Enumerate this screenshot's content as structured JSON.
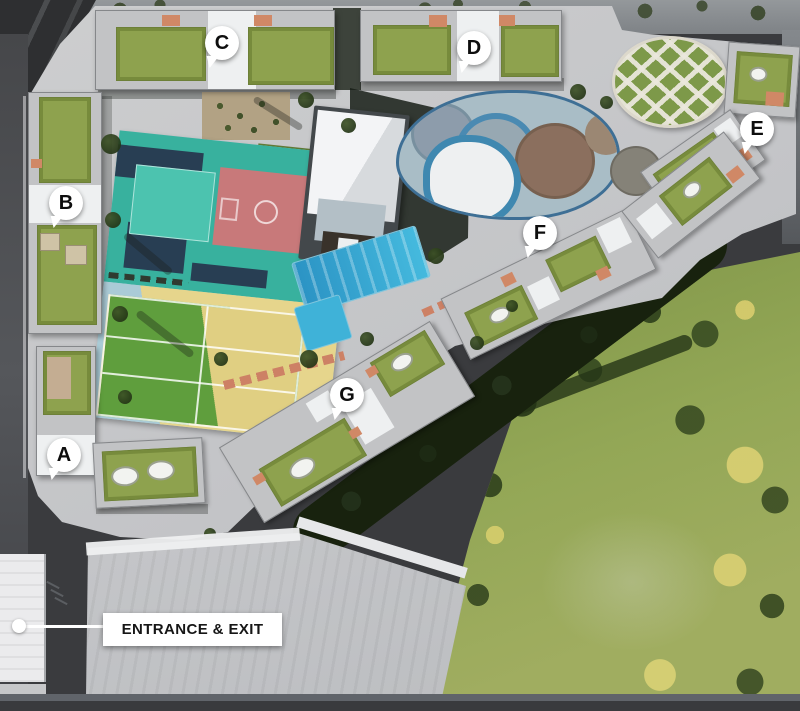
{
  "plan": {
    "type": "residential-masterplan-aerial",
    "markers": [
      {
        "letter": "A"
      },
      {
        "letter": "B"
      },
      {
        "letter": "C"
      },
      {
        "letter": "D"
      },
      {
        "letter": "E"
      },
      {
        "letter": "F"
      },
      {
        "letter": "G"
      }
    ],
    "entrance_label": "ENTRANCE & EXIT",
    "areas": [
      "building-a",
      "building-b",
      "building-c",
      "building-d",
      "building-e",
      "building-f",
      "building-g",
      "basketball-court",
      "tennis-court",
      "swimming-pool",
      "kids-water-playground",
      "clubhouse",
      "circular-garden",
      "orchard-garden",
      "lawn",
      "central-park",
      "entrance-building",
      "roads"
    ],
    "colors": {
      "road_dark": "#3a3b3e",
      "site_ground": "#c7c8ca",
      "park_green": "#8ba14f",
      "tree_dark": "#2a3d1a",
      "tree_yellow": "#ddd06e",
      "pool_blue": "#39aed8",
      "court_teal": "#38b19e",
      "court_navy": "#27344d",
      "court_red": "#c8797a",
      "tennis_green": "#5f9e3d",
      "tennis_yellow": "#eeda8e",
      "apron_blue": "#aacbd6",
      "roof_garden": "#8ea24e",
      "roof_light": "#c2c3c5",
      "patio_salmon": "#d08866",
      "marker_bg": "#ffffff",
      "marker_text": "#0e0e0e"
    }
  }
}
